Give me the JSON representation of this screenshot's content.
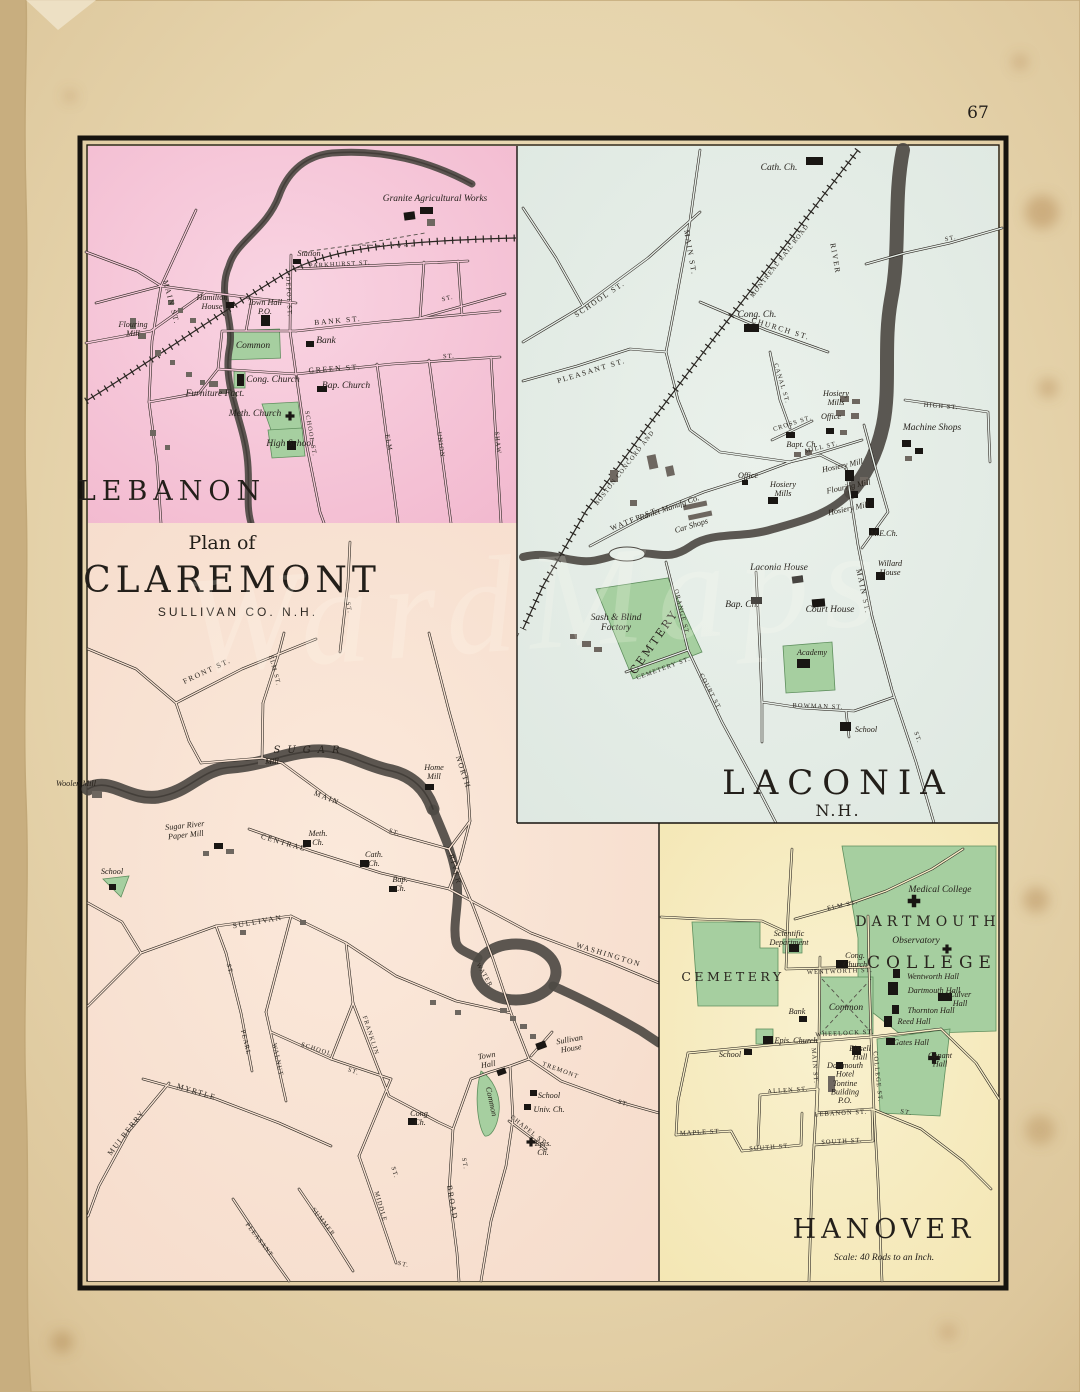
{
  "page": {
    "number": "67"
  },
  "watermark": "WardMaps",
  "lebanon": {
    "title": "LEBANON",
    "streets": {
      "parkhurst": "PARKHURST ST.",
      "main": "MAIN ST.",
      "depot": "DEPOT ST.",
      "bank": "BANK ST.",
      "green": "GREEN ST.",
      "school": "SCHOOL ST.",
      "elm": "ELM",
      "union": "UNION",
      "shaw": "SHAW",
      "st": "ST."
    },
    "pois": {
      "granite_works": "Granite Agricultural Works",
      "station": "Station",
      "hamilton_house": "Hamilton\nHouse",
      "town_hall": "Town Hall\nP.O.",
      "flouring_mill": "Flouring\nMill",
      "common": "Common",
      "bank": "Bank",
      "cong_church": "Cong. Church",
      "bap_church": "Bap. Church",
      "furniture": "Furniture Fact.",
      "meth_church": "Meth. Church",
      "high_school": "High School"
    }
  },
  "laconia": {
    "title": "LACONIA",
    "subtitle": "N.H.",
    "railroad_1": "BOSTON CONCORD AND",
    "railroad_2": "MONTREAL RAIL ROAD",
    "cemtery": "CEMTERY",
    "streets": {
      "main": "MAIN ST.",
      "school": "SCHOOL ST.",
      "pleasant": "PLEASANT ST.",
      "church": "CHURCH ST.",
      "canal": "CANAL ST.",
      "water": "WATER ST.",
      "mill": "MILL ST.",
      "cross": "CROSS ST.",
      "high": "HIGH ST.",
      "lake": "LAKE",
      "orange": "ORANGE ST.",
      "cemetery": "CEMETERY ST.",
      "court": "COURT ST.",
      "bowman": "BOWMAN ST.",
      "river": "RIVER",
      "st": "ST."
    },
    "pois": {
      "cath_ch": "Cath. Ch.",
      "cong_ch": "Cong. Ch.",
      "bapt_ch": "Bapt. Ch.",
      "hosiery_mills": "Hosiery\nMills",
      "office": "Office",
      "machine_shops": "Machine Shops",
      "ranlet": "Ranlet Manufg Co.",
      "car_shops": "Car Shops",
      "hosiery_mill": "Hosiery Mill",
      "flouring_mill": "Flouring Mill",
      "me_ch": "M.E.Ch.",
      "laconia_house": "Laconia House",
      "willard_house": "Willard\nHouse",
      "bap_ch": "Bap. Ch.",
      "court_house": "Court House",
      "sash_blind": "Sash & Blind\nFactory",
      "foundry": "Foundry",
      "academy": "Academy",
      "school": "School"
    }
  },
  "claremont": {
    "pretitle": "Plan of",
    "title": "CLAREMONT",
    "subtitle": "SULLIVAN CO. N.H.",
    "river_name": "SUGAR",
    "streets": {
      "front": "FRONT ST.",
      "elm": "ELM ST.",
      "north": "NORTH",
      "main": "MAIN",
      "central": "CENTRAL",
      "sullivan": "SULLIVAN",
      "pearl": "PEARL",
      "walnut": "WALNUT",
      "school": "SCHOOL",
      "franklin": "FRANKLIN",
      "myrtle": "MYRTLE",
      "mulberry": "MULBERRY",
      "summer": "SUMMER",
      "middle": "MIDDLE",
      "pleasant": "PLEASANT",
      "broad": "BROAD",
      "tremont": "TREMONT",
      "chapel": "CHAPEL ST.",
      "water": "WATER",
      "washington": "WASHINGTON",
      "river": "RIVER",
      "st": "ST."
    },
    "pois": {
      "woolen_mill": "Woolen Mill",
      "paper_mill": "Sugar River\nPaper Mill",
      "school": "School",
      "mill": "Mill",
      "home_mill": "Home\nMill",
      "meth_ch": "Meth.\nCh.",
      "cath_ch": "Cath.\nCh.",
      "bap_ch": "Bap.\nCh.",
      "cong_ch": "Cong.\nCh.",
      "sullivan_house": "Sullivan\nHouse",
      "town_hall": "Town\nHall",
      "common": "Common",
      "univ_ch": "Univ. Ch.",
      "epis_ch": "Epis.\nCh."
    }
  },
  "hanover": {
    "title": "HANOVER",
    "scale": "Scale: 40 Rods to an Inch.",
    "college_1": "DARTMOUTH",
    "college_2": "COLLEGE",
    "cemetery": "CEMETERY",
    "streets": {
      "elm": "ELM ST.",
      "wentworth": "WENTWORTH ST.",
      "wheelock": "WHEELOCK ST.",
      "main": "MAIN ST.",
      "college": "COLLEGE ST.",
      "allen": "ALLEN ST.",
      "lebanon": "LEBANON ST.",
      "south": "SOUTH ST.",
      "maple": "MAPLE ST.",
      "st": "ST."
    },
    "pois": {
      "medical_college": "Medical College",
      "observatory": "Observatory",
      "scientific": "Scientific\nDepartment",
      "cong_church": "Cong.\nChurch",
      "common": "Common",
      "bank": "Bank",
      "epis_church": "Epis. Church",
      "school": "School",
      "wentworth_hall": "Wentworth Hall",
      "dartmouth_hall": "Dartmouth Hall",
      "culver_hall": "Culver\nHall",
      "thornton_hall": "Thornton Hall",
      "reed_hall": "Reed Hall",
      "bissell_hall": "Bissell\nHall",
      "dartmouth_hotel": "Dartmouth\nHotel",
      "tontine": "Tontine\nBuilding\nP.O.",
      "gates_hall": "Gates Hall",
      "conant_hall": "Conant\nHall"
    }
  }
}
